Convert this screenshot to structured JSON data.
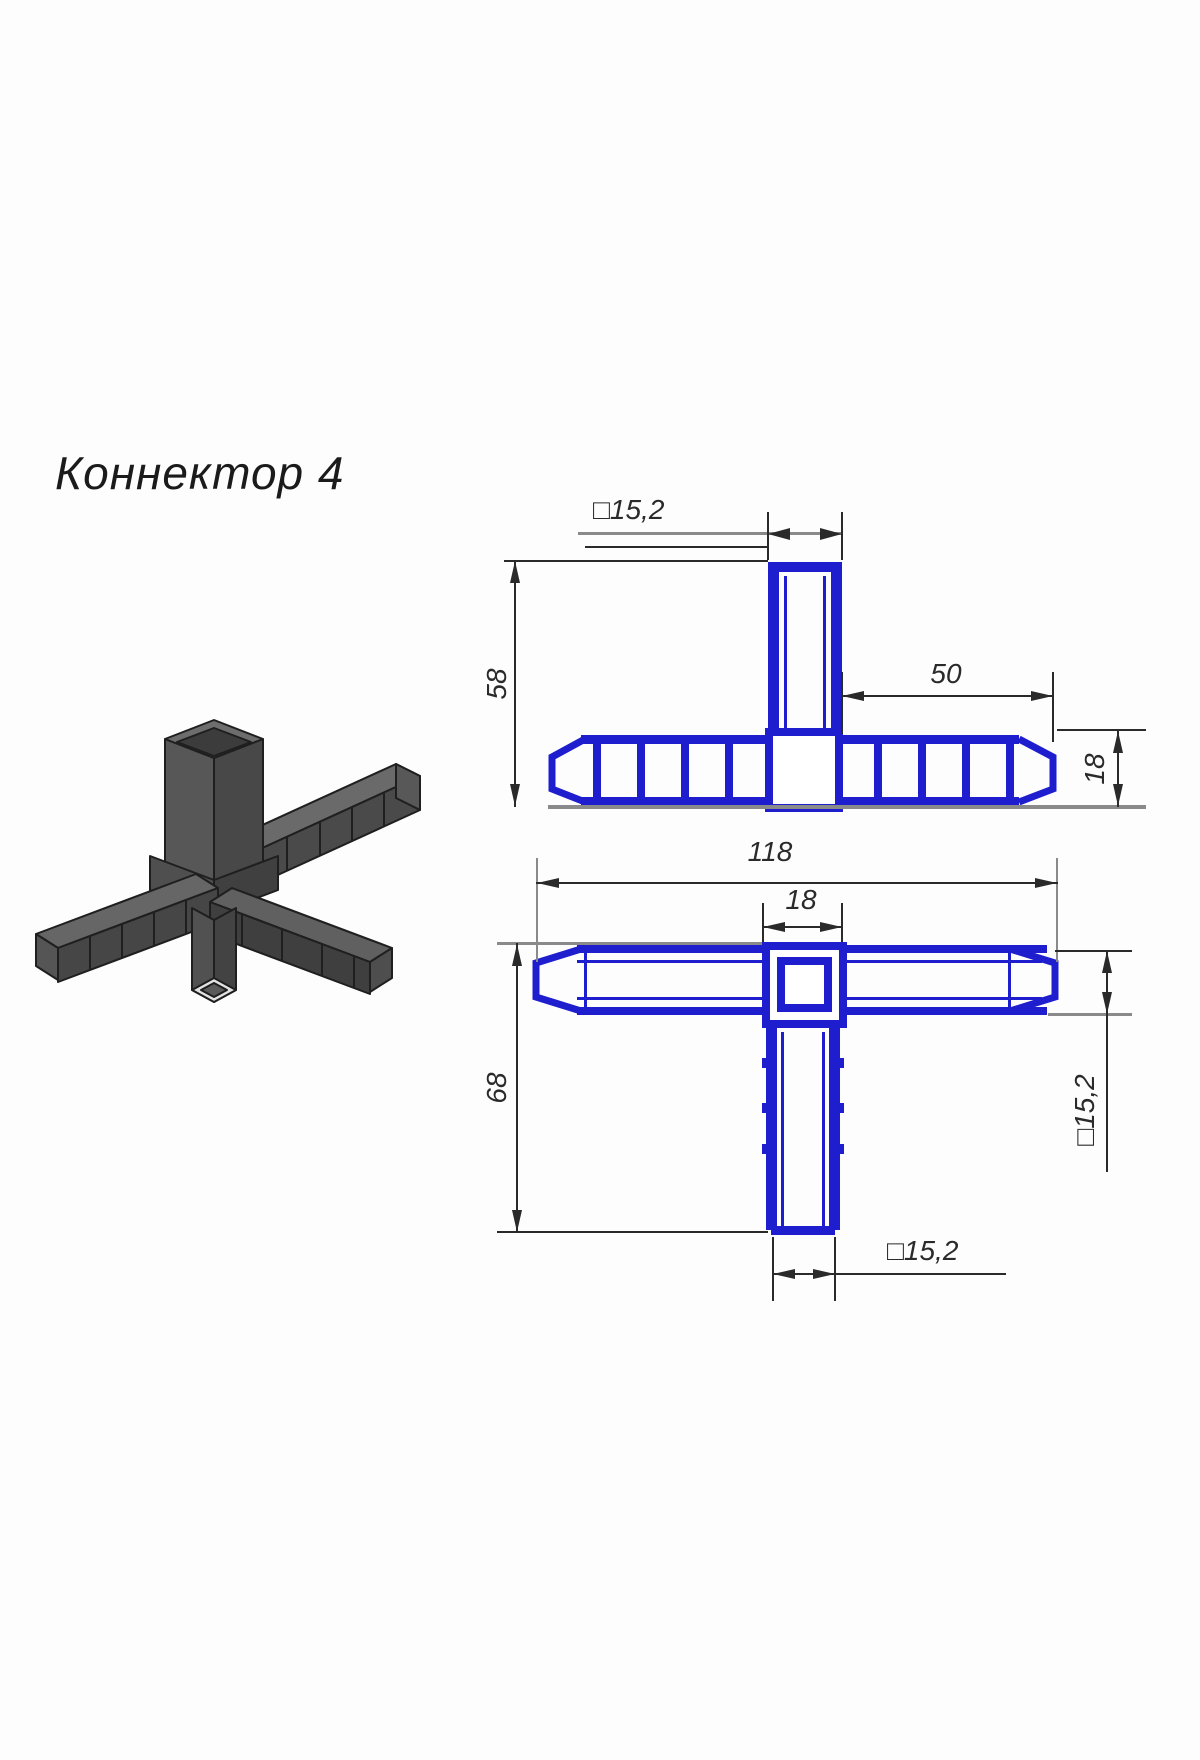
{
  "title": "Коннектор 4",
  "part": "4-way square tube connector",
  "colors": {
    "profile_blue": "#1e1ecf",
    "dimension_gray": "#8a8a8a",
    "line_black": "#2a2a2a",
    "metal_light": "#6a6a6a",
    "metal_mid": "#535353",
    "metal_dark": "#434343"
  },
  "dimensions": {
    "front": {
      "tube_square": "□15,2",
      "tube_height": "58",
      "arm_length": "50",
      "bar_height": "18"
    },
    "plan": {
      "total_length": "118",
      "center_width": "18",
      "total_height": "68",
      "right_square": "□15,2",
      "bottom_square": "□15,2"
    }
  }
}
